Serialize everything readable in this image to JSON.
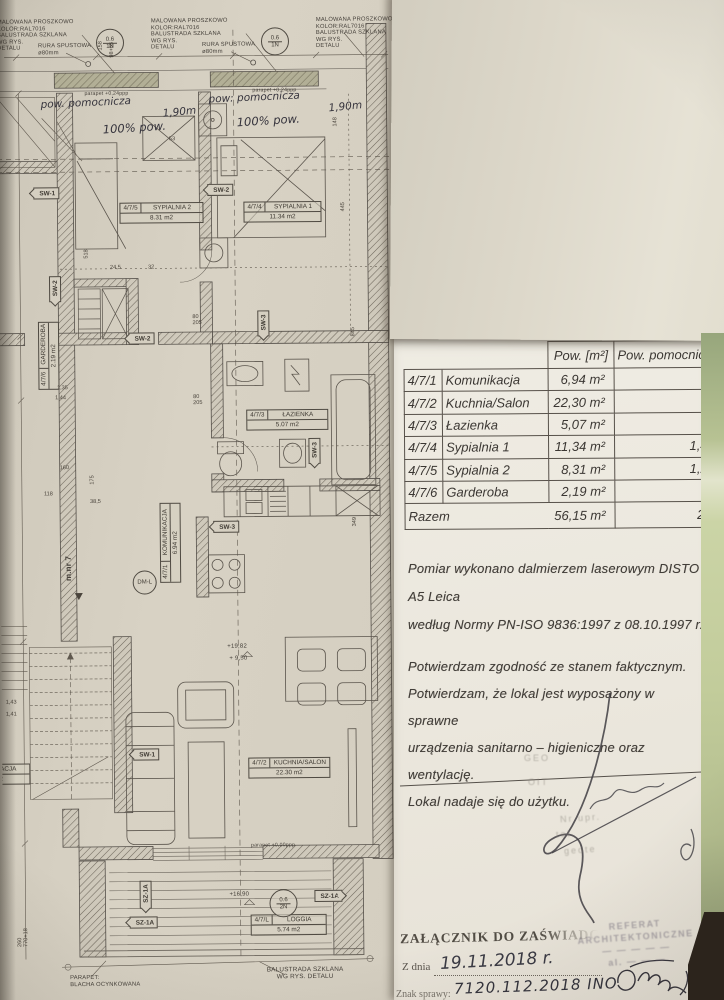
{
  "document": {
    "table": {
      "header_area": "Pow. [m²]",
      "header_aux": "Pow. pomocnic",
      "rows": [
        {
          "id": "4/7/1",
          "name": "Komunikacja",
          "area": "6,94 m²",
          "aux": ""
        },
        {
          "id": "4/7/2",
          "name": "Kuchnia/Salon",
          "area": "22,30 m²",
          "aux": ""
        },
        {
          "id": "4/7/3",
          "name": "Łazienka",
          "area": "5,07 m²",
          "aux": ""
        },
        {
          "id": "4/7/4",
          "name": "Sypialnia 1",
          "area": "11,34 m²",
          "aux": "1,4"
        },
        {
          "id": "4/7/5",
          "name": "Sypialnia 2",
          "area": "8,31 m²",
          "aux": "1,2"
        },
        {
          "id": "4/7/6",
          "name": "Garderoba",
          "area": "2,19 m²",
          "aux": ""
        }
      ],
      "total": {
        "label": "Razem",
        "area": "56,15 m²",
        "aux": "2,"
      }
    },
    "measurement_note": "Pomiar wykonano dalmierzem laserowym DISTO A5 Leica\nwedług Normy PN-ISO 9836:1997 z 08.10.1997 r.",
    "confirmation": "Potwierdzam zgodność ze stanem faktycznym.\nPotwierdzam, że lokal jest wyposażony w sprawne\nurządzenia sanitarno – higieniczne oraz wentylację.\nLokal nadaje się do użytku.",
    "signature_stamp": {
      "fragments": [
        "GEO",
        "OIT",
        "Nr upr.",
        "tel.",
        "geote"
      ]
    },
    "attachment_stamp": {
      "title": "ZAŁĄCZNIK DO ZAŚWIADC",
      "date_label": "Z dnia",
      "date_value": "19.11.2018 r.",
      "case_label": "Znak sprawy:",
      "case_value": "7120.112.2018 INO"
    },
    "office_stamp": {
      "lines": [
        "REFERAT",
        "ARCHITEKTONICZNE",
        "— — — — —",
        "al. — — —"
      ]
    }
  },
  "plan": {
    "rooms": [
      {
        "id": "4/7/5",
        "name": "SYPIALNIA 2",
        "area": "8.31 m2"
      },
      {
        "id": "4/7/4",
        "name": "SYPIALNIA 1",
        "area": "11.34 m2"
      },
      {
        "id": "4/7/3",
        "name": "ŁAZIENKA",
        "area": "5.07 m2"
      },
      {
        "id": "4/7/2",
        "name": "KUCHNIA/SALON",
        "area": "22.30 m2"
      },
      {
        "id": "4/7/L",
        "name": "LOGGIA",
        "area": "5.74 m2"
      },
      {
        "id": "4/7/6",
        "name": "GARDEROBA",
        "area": "2.19 m2"
      },
      {
        "id": "4/7/1",
        "name": "KOMUNIKACJA",
        "area": "6.94 m2"
      },
      {
        "id": "",
        "name": "KOMUNIKACJA",
        "area": ",14 m2"
      }
    ],
    "sections": [
      "SW-1",
      "SW-2",
      "SW-2",
      "SW-2",
      "SW-3",
      "SW-3",
      "SW-3",
      "SW-1",
      "SZ-1A",
      "SZ-1A",
      "SZ-1A"
    ],
    "circles": [
      {
        "top": "0.6",
        "bottom": "1N"
      },
      {
        "top": "0.6",
        "bottom": "1N"
      },
      {
        "top": "0.6",
        "bottom": "2N"
      },
      {
        "label": "DM-L"
      }
    ],
    "handwritten": [
      "pow. pomocnicza",
      "pow: pomocnicza",
      "1,90m",
      "1,90m",
      "100% pow.",
      "100% pow."
    ],
    "notes": {
      "spec": "MALOWANA PROSZKOWO\nKOLOR:RAL7016\nBALUSTRADA SZKLANA\nWG RYS.\nDETALU",
      "rura": "RURA SPUSTOWA\nø80mm",
      "balustrada_bottom": "BALUSTRADA SZKLANA\nWG RYS.  DETALU",
      "parapet_bottom": "PARAPET:\nBLACHA OCYNKOWANA",
      "parapet24": "parapet +0,24ppp",
      "parapet00": "parapet +0,00ppp",
      "level1": "+19,82",
      "level2": "+ 9,50",
      "level3": "+16,90",
      "mnr": "m.nr 7"
    },
    "dims": [
      "158",
      "98+65",
      "845",
      "349",
      "445",
      "148",
      "518",
      "24,5",
      "160",
      "118",
      "1,35",
      "1,44",
      "175",
      "38,5",
      "80\n205",
      "80\n205",
      "260\n770+18",
      "1,43",
      "1,41",
      "53",
      "32"
    ]
  }
}
